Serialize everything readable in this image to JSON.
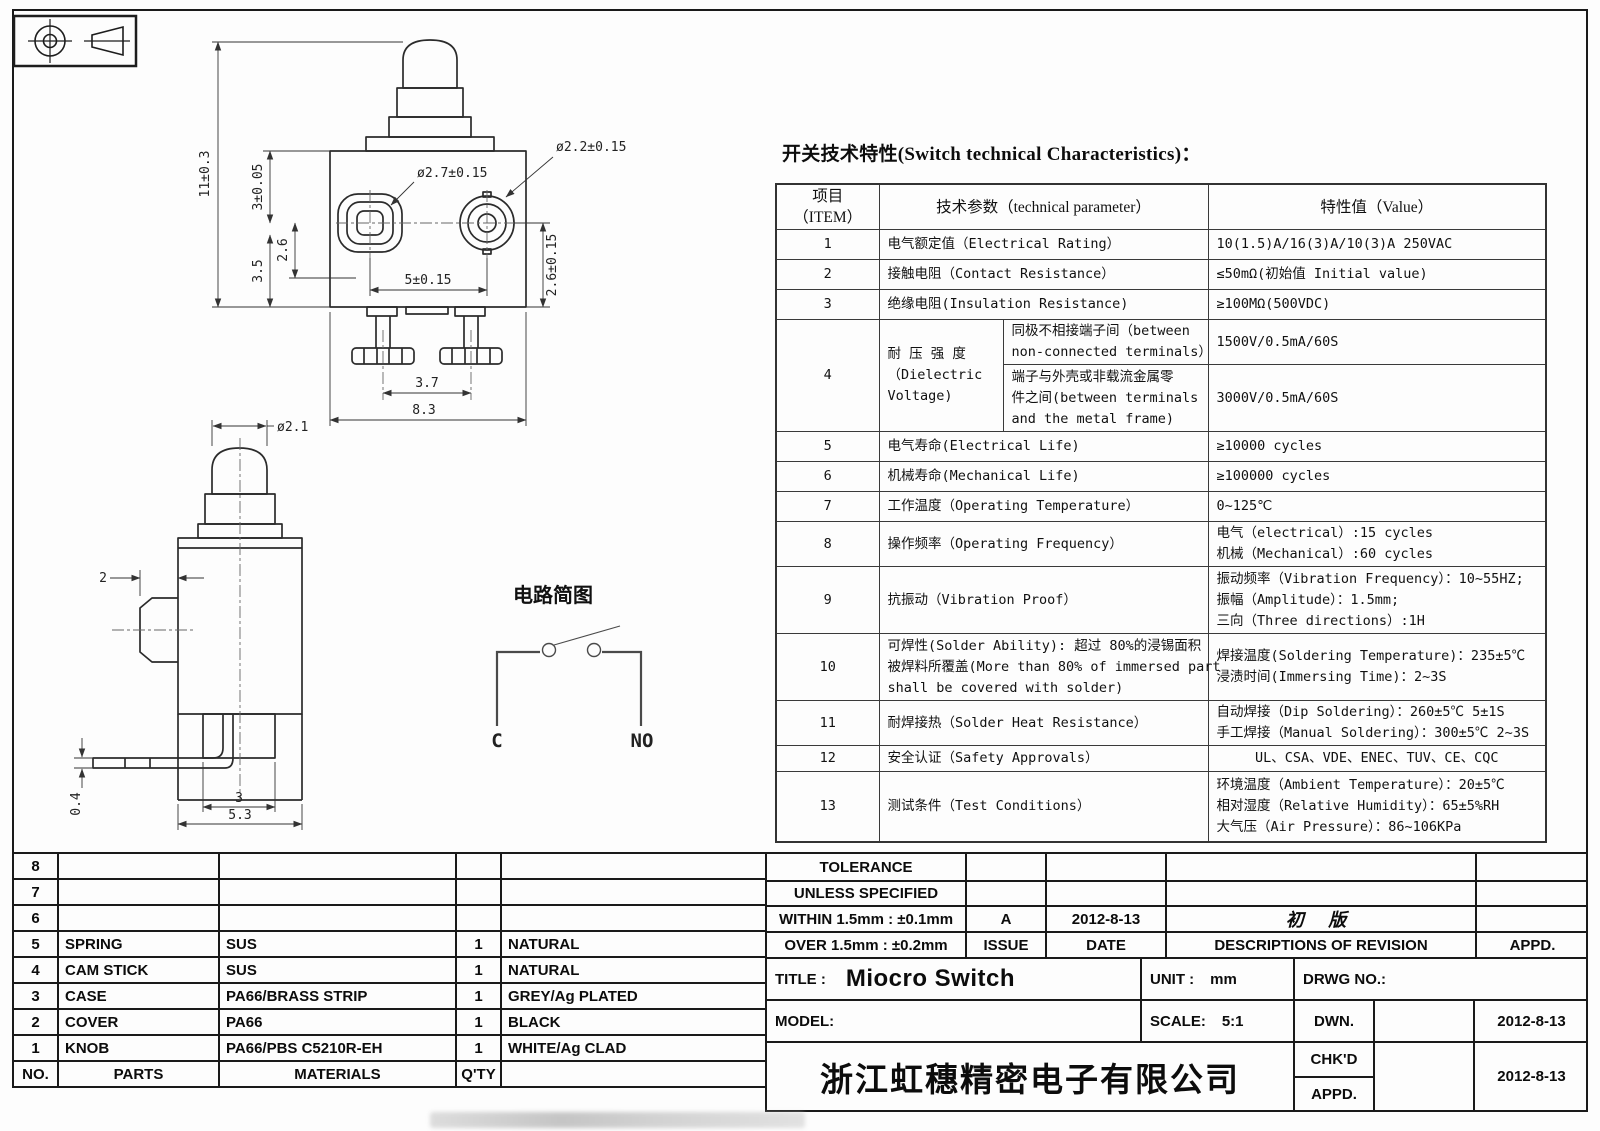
{
  "tech": {
    "title": "开关技术特性(Switch technical Characteristics)：",
    "head": {
      "item1": "项目",
      "item2": "（ITEM）",
      "param": "技术参数（technical parameter）",
      "value": "特性值（Value）"
    },
    "r1": {
      "no": "1",
      "p": "电气额定值（Electrical Rating）",
      "v": "10(1.5)A/16(3)A/10(3)A  250VAC"
    },
    "r2": {
      "no": "2",
      "p": "接触电阻（Contact  Resistance）",
      "v": "≤50mΩ(初始值 Initial value)"
    },
    "r3": {
      "no": "3",
      "p": "绝缘电阻(Insulation Resistance)",
      "v": "≥100MΩ(500VDC)"
    },
    "r4": {
      "no": "4",
      "p1": "耐 压 强 度",
      "p2": "（Dielectric",
      "p3": "Voltage)",
      "s1a": "同极不相接端子间（between",
      "s1b": "non-connected terminals）",
      "v1": "1500V/0.5mA/60S",
      "s2a": "端子与外壳或非载流金属零",
      "s2b": "件之间(between terminals",
      "s2c": "and the metal frame)",
      "v2": "3000V/0.5mA/60S"
    },
    "r5": {
      "no": "5",
      "p": "电气寿命(Electrical Life)",
      "v": "≥10000 cycles"
    },
    "r6": {
      "no": "6",
      "p": "机械寿命(Mechanical Life)",
      "v": "≥100000 cycles"
    },
    "r7": {
      "no": "7",
      "p": "工作温度（Operating Temperature）",
      "v": "0~125℃"
    },
    "r8": {
      "no": "8",
      "p": "操作频率（Operating Frequency）",
      "v1": "电气（electrical）:15 cycles",
      "v2": "机械（Mechanical）:60 cycles"
    },
    "r9": {
      "no": "9",
      "p": "抗振动（Vibration Proof）",
      "v1": "振动频率（Vibration Frequency）：10~55HZ;",
      "v2": "振幅（Amplitude）：1.5mm;",
      "v3": "三向（Three directions）:1H"
    },
    "r10": {
      "no": "10",
      "p1": "可焊性(Solder Ability): 超过 80%的浸锡面积",
      "p2": "被焊料所覆盖(More than 80% of immersed part",
      "p3": "shall be covered with solder)",
      "v1": "焊接温度(Soldering Temperature)：235±5℃",
      "v2": "浸渍时间(Immersing Time)：2~3S"
    },
    "r11": {
      "no": "11",
      "p": "耐焊接热（Solder Heat Resistance）",
      "v1": "自动焊接（Dip Soldering）：260±5℃ 5±1S",
      "v2": "手工焊接（Manual Soldering）：300±5℃ 2~3S"
    },
    "r12": {
      "no": "12",
      "p": "安全认证（Safety Approvals）",
      "v": "UL、CSA、VDE、ENEC、TUV、CE、CQC"
    },
    "r13": {
      "no": "13",
      "p": "测试条件（Test Conditions）",
      "v1": "环境温度（Ambient Temperature）：20±5℃",
      "v2": "相对湿度（Relative Humidity）：65±5%RH",
      "v3": "大气压（Air Pressure）：86~106KPa"
    }
  },
  "front": {
    "h11": "11±0.3",
    "h3": "3±0.05",
    "h26": "2.6",
    "h35": "3.5",
    "d27": "ø2.7±0.15",
    "d22": "ø2.2±0.15",
    "p5": "5±0.15",
    "r26": "2.6±0.15",
    "p37": "3.7",
    "w83": "8.3"
  },
  "side": {
    "d21": "ø2.1",
    "w2": "2",
    "t04": "0.4",
    "p3": "3",
    "w53": "5.3"
  },
  "circuit": {
    "title": "电路简图",
    "c": "C",
    "no": "NO"
  },
  "parts": {
    "rows": [
      {
        "no": "8",
        "part": "",
        "mat": "",
        "qty": "",
        "fin": ""
      },
      {
        "no": "7",
        "part": "",
        "mat": "",
        "qty": "",
        "fin": ""
      },
      {
        "no": "6",
        "part": "",
        "mat": "",
        "qty": "",
        "fin": ""
      },
      {
        "no": "5",
        "part": "SPRING",
        "mat": "SUS",
        "qty": "1",
        "fin": "NATURAL"
      },
      {
        "no": "4",
        "part": "CAM STICK",
        "mat": "SUS",
        "qty": "1",
        "fin": "NATURAL"
      },
      {
        "no": "3",
        "part": "CASE",
        "mat": "PA66/BRASS STRIP",
        "qty": "1",
        "fin": "GREY/Ag PLATED"
      },
      {
        "no": "2",
        "part": "COVER",
        "mat": "PA66",
        "qty": "1",
        "fin": "BLACK"
      },
      {
        "no": "1",
        "part": "KNOB",
        "mat": "PA66/PBS C5210R-EH",
        "qty": "1",
        "fin": "WHITE/Ag CLAD"
      }
    ],
    "footer": {
      "no": "NO.",
      "part": "PARTS",
      "mat": "MATERIALS",
      "qty": "Q'TY",
      "fin": ""
    }
  },
  "titleblock": {
    "tolerance1": "TOLERANCE",
    "tolerance2": "UNLESS  SPECIFIED",
    "tol_within": "WITHIN 1.5mm : ±0.1mm",
    "tol_over": "OVER 1.5mm : ±0.2mm",
    "issue_value": "A",
    "issue_date": "2012-8-13",
    "revision_desc": "初 版",
    "col_issue": "ISSUE",
    "col_date": "DATE",
    "col_desc": "DESCRIPTIONS OF REVISION",
    "col_appd": "APPD.",
    "title_label": "TITLE :",
    "title_value": "Miocro Switch",
    "unit_label": "UNIT :",
    "unit_value": "mm",
    "drwg_label": "DRWG NO.:",
    "model_label": "MODEL:",
    "scale_label": "SCALE:",
    "scale_value": "5:1",
    "dwn_label": "DWN.",
    "dwn_date": "2012-8-13",
    "chkd_label": "CHK'D",
    "chkd_date": "2012-8-13",
    "appd_label": "APPD.",
    "company": "浙江虹穗精密电子有限公司"
  }
}
